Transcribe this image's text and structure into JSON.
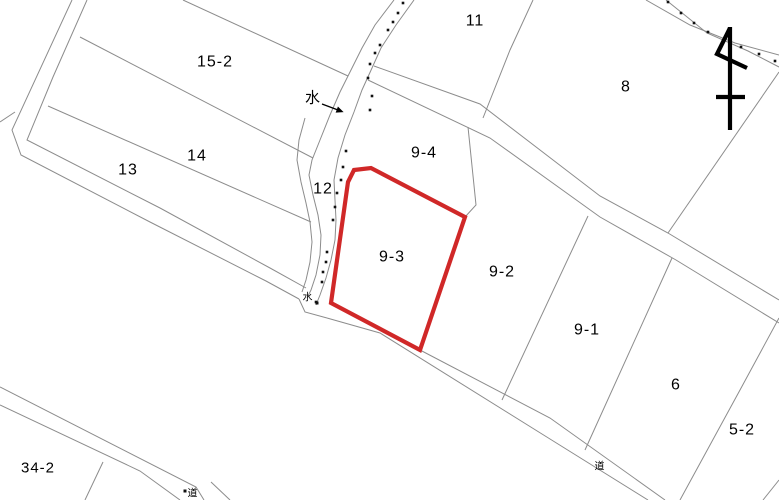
{
  "map": {
    "width": 779,
    "height": 500,
    "colors": {
      "background": "#ffffff",
      "boundary": "#8c8c8c",
      "highlight": "#d02828",
      "text": "#000000",
      "dot": "#111111"
    },
    "highlight_parcel": {
      "label": "9-3",
      "points": [
        [
          354,
          170
        ],
        [
          371,
          168
        ],
        [
          465,
          217
        ],
        [
          420,
          350
        ],
        [
          331,
          303
        ],
        [
          348,
          182
        ]
      ],
      "stroke_width": 4.2
    },
    "parcels": [
      {
        "label": "15-2",
        "x": 215,
        "y": 62,
        "size": 16
      },
      {
        "label": "14",
        "x": 197,
        "y": 156,
        "size": 16
      },
      {
        "label": "13",
        "x": 128,
        "y": 170,
        "size": 16
      },
      {
        "label": "12",
        "x": 323,
        "y": 189,
        "size": 16
      },
      {
        "label": "11",
        "x": 475,
        "y": 21,
        "size": 16
      },
      {
        "label": "9-4",
        "x": 424,
        "y": 153,
        "size": 16
      },
      {
        "label": "9-3",
        "x": 392,
        "y": 257,
        "size": 16
      },
      {
        "label": "9-2",
        "x": 502,
        "y": 272,
        "size": 16
      },
      {
        "label": "9-1",
        "x": 587,
        "y": 330,
        "size": 16
      },
      {
        "label": "8",
        "x": 626,
        "y": 87,
        "size": 16
      },
      {
        "label": "6",
        "x": 676,
        "y": 385,
        "size": 16
      },
      {
        "label": "5-2",
        "x": 742,
        "y": 430,
        "size": 16
      },
      {
        "label": "34-2",
        "x": 38,
        "y": 468,
        "size": 15
      }
    ],
    "boundaries": [
      {
        "name": "nw-road-outer-edge",
        "points": [
          [
            72,
            0
          ],
          [
            12,
            130
          ],
          [
            21,
            155
          ],
          [
            150,
            222
          ],
          [
            266,
            281
          ],
          [
            299,
            299
          ]
        ]
      },
      {
        "name": "nw-road-inner-edge",
        "points": [
          [
            87,
            0
          ],
          [
            53,
            77
          ],
          [
            27,
            140
          ],
          [
            160,
            208
          ],
          [
            270,
            268
          ],
          [
            306,
            288
          ]
        ]
      },
      {
        "name": "west-edge-stub",
        "points": [
          [
            0,
            122
          ],
          [
            15,
            112
          ]
        ]
      },
      {
        "name": "parcel15-2-north",
        "points": [
          [
            183,
            0
          ],
          [
            348,
            76
          ]
        ]
      },
      {
        "name": "parcel15-2-14-boundary",
        "points": [
          [
            80,
            37
          ],
          [
            313,
            158
          ]
        ]
      },
      {
        "name": "parcel14-13-boundary",
        "points": [
          [
            48,
            106
          ],
          [
            311,
            222
          ]
        ]
      },
      {
        "name": "stream-west-edge",
        "points": [
          [
            394,
            0
          ],
          [
            375,
            25
          ],
          [
            362,
            48
          ],
          [
            352,
            68
          ],
          [
            340,
            92
          ],
          [
            330,
            115
          ],
          [
            320,
            140
          ],
          [
            312,
            160
          ],
          [
            309,
            175
          ],
          [
            313,
            195
          ],
          [
            318,
            215
          ],
          [
            321,
            235
          ],
          [
            320,
            255
          ],
          [
            316,
            275
          ],
          [
            311,
            290
          ],
          [
            307,
            298
          ]
        ]
      },
      {
        "name": "stream-east-edge",
        "points": [
          [
            414,
            0
          ],
          [
            396,
            25
          ],
          [
            381,
            48
          ],
          [
            372,
            68
          ],
          [
            362,
            90
          ],
          [
            354,
            112
          ],
          [
            345,
            135
          ],
          [
            338,
            158
          ],
          [
            334,
            180
          ],
          [
            335,
            200
          ],
          [
            336,
            220
          ],
          [
            335,
            240
          ],
          [
            331,
            260
          ],
          [
            326,
            278
          ],
          [
            320,
            295
          ],
          [
            316,
            305
          ]
        ]
      },
      {
        "name": "parcel12-west-edge",
        "points": [
          [
            305,
            118
          ],
          [
            299,
            140
          ],
          [
            297,
            160
          ],
          [
            301,
            182
          ],
          [
            306,
            203
          ],
          [
            310,
            222
          ],
          [
            312,
            242
          ],
          [
            310,
            262
          ],
          [
            306,
            280
          ],
          [
            302,
            292
          ]
        ]
      },
      {
        "name": "ne-road-upper-edge",
        "points": [
          [
            374,
            66
          ],
          [
            480,
            104
          ],
          [
            600,
            196
          ],
          [
            668,
            233
          ],
          [
            779,
            300
          ]
        ]
      },
      {
        "name": "ne-road-lower-edge",
        "points": [
          [
            368,
            80
          ],
          [
            490,
            138
          ],
          [
            600,
            217
          ],
          [
            676,
            260
          ],
          [
            779,
            323
          ]
        ]
      },
      {
        "name": "parcel11-8-boundary",
        "points": [
          [
            533,
            0
          ],
          [
            510,
            50
          ],
          [
            483,
            118
          ]
        ]
      },
      {
        "name": "parcel8-east-boundary",
        "points": [
          [
            779,
            72
          ],
          [
            668,
            233
          ]
        ]
      },
      {
        "name": "ne-stream-outer-edge",
        "points": [
          [
            646,
            0
          ],
          [
            690,
            25
          ],
          [
            735,
            43
          ],
          [
            779,
            55
          ]
        ]
      },
      {
        "name": "ne-stream-inner-edge",
        "points": [
          [
            666,
            0
          ],
          [
            707,
            33
          ],
          [
            748,
            51
          ],
          [
            779,
            67
          ]
        ]
      },
      {
        "name": "parcel9-4-9-2-boundary",
        "points": [
          [
            468,
            127
          ],
          [
            476,
            205
          ],
          [
            465,
            217
          ]
        ]
      },
      {
        "name": "parcel9-2-9-1-boundary",
        "points": [
          [
            588,
            216
          ],
          [
            502,
            400
          ]
        ]
      },
      {
        "name": "parcel9-1-6-boundary",
        "points": [
          [
            672,
            258
          ],
          [
            585,
            450
          ]
        ]
      },
      {
        "name": "parcel6-5-2-boundary",
        "points": [
          [
            779,
            318
          ],
          [
            740,
            390
          ],
          [
            680,
            500
          ]
        ]
      },
      {
        "name": "se-corner-boundary",
        "points": [
          [
            779,
            480
          ],
          [
            763,
            500
          ]
        ]
      },
      {
        "name": "south-road-upper-edge",
        "points": [
          [
            330,
            303
          ],
          [
            420,
            350
          ],
          [
            550,
            418
          ],
          [
            665,
            500
          ]
        ]
      },
      {
        "name": "south-road-lower-edge",
        "points": [
          [
            327,
            318
          ],
          [
            380,
            333
          ],
          [
            550,
            439
          ],
          [
            648,
            500
          ]
        ]
      },
      {
        "name": "junction-connector",
        "points": [
          [
            299,
            299
          ],
          [
            305,
            312
          ],
          [
            327,
            318
          ]
        ]
      },
      {
        "name": "sw-road-upper-edge",
        "points": [
          [
            0,
            387
          ],
          [
            196,
            487
          ],
          [
            204,
            500
          ]
        ]
      },
      {
        "name": "sw-road-lower-edge",
        "points": [
          [
            0,
            405
          ],
          [
            140,
            471
          ],
          [
            180,
            500
          ]
        ]
      },
      {
        "name": "sw-road-continuation",
        "points": [
          [
            211,
            482
          ],
          [
            230,
            500
          ]
        ]
      },
      {
        "name": "parcel34-2-boundary",
        "points": [
          [
            103,
            462
          ],
          [
            85,
            500
          ]
        ]
      }
    ],
    "stream_dots": [
      [
        403,
        3
      ],
      [
        398,
        13
      ],
      [
        393,
        22
      ],
      [
        388,
        30
      ],
      [
        380,
        45
      ],
      [
        375,
        53
      ],
      [
        370,
        64
      ],
      [
        368,
        78
      ],
      [
        372,
        96
      ],
      [
        370,
        110
      ],
      [
        346,
        151
      ],
      [
        343,
        167
      ],
      [
        341,
        180
      ],
      [
        337,
        193
      ],
      [
        335,
        207
      ],
      [
        333,
        220
      ],
      [
        327,
        252
      ],
      [
        326,
        262
      ],
      [
        323,
        272
      ],
      [
        322,
        282
      ],
      [
        316,
        302
      ],
      [
        668,
        2
      ],
      [
        681,
        13
      ],
      [
        694,
        23
      ],
      [
        708,
        32
      ],
      [
        724,
        40
      ],
      [
        741,
        47
      ],
      [
        759,
        54
      ],
      [
        775,
        61
      ]
    ],
    "annotations": [
      {
        "name": "water-label-upper",
        "text": "水",
        "x": 313,
        "y": 98,
        "size": 15,
        "arrow": {
          "from": [
            322,
            104
          ],
          "to": [
            338,
            110
          ]
        }
      },
      {
        "name": "water-label-junction",
        "text": "水",
        "x": 308,
        "y": 298,
        "size": 10,
        "dot": [
          317,
          303
        ]
      },
      {
        "name": "road-label-southwest",
        "text": "道",
        "x": 193,
        "y": 494,
        "size": 10,
        "dot": [
          185,
          491
        ]
      },
      {
        "name": "road-label-southeast",
        "text": "道",
        "x": 600,
        "y": 467,
        "size": 10
      }
    ],
    "north_arrow": {
      "shaft": [
        [
          730,
          27
        ],
        [
          730,
          130
        ]
      ],
      "crossbar": [
        [
          716,
          97
        ],
        [
          745,
          97
        ]
      ],
      "flag": [
        [
          730,
          28
        ],
        [
          717,
          54
        ],
        [
          747,
          68
        ]
      ],
      "stroke_width": 4.2
    }
  }
}
